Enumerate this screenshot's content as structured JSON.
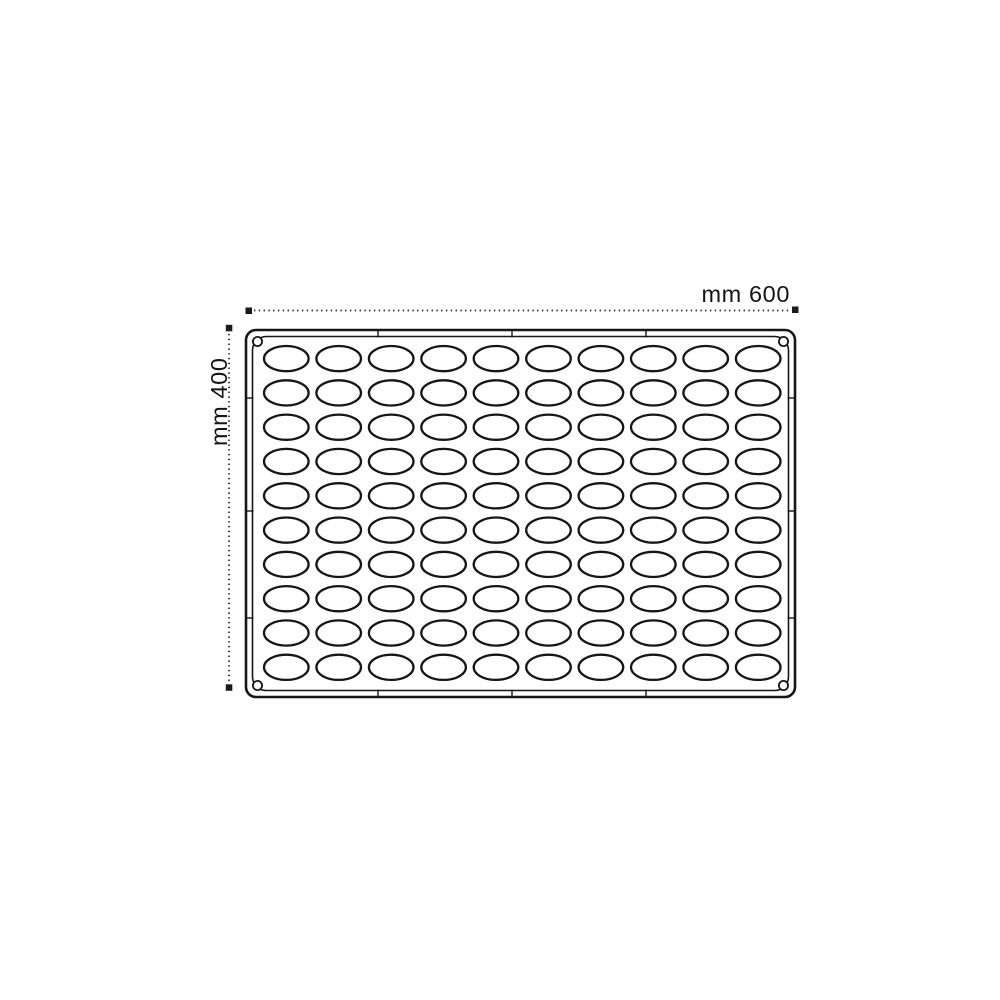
{
  "drawing": {
    "type": "technical drawing of baking mold tray (top view)",
    "width_label": "mm 600",
    "height_label": "mm 400",
    "width_mm": 600,
    "height_mm": 400
  },
  "mold": {
    "rows": 10,
    "columns": 10,
    "cavity_count": 100,
    "cavity_shape": "oval",
    "corner_holes": 4
  },
  "colors": {
    "line": "#161616",
    "background": "#ffffff"
  }
}
